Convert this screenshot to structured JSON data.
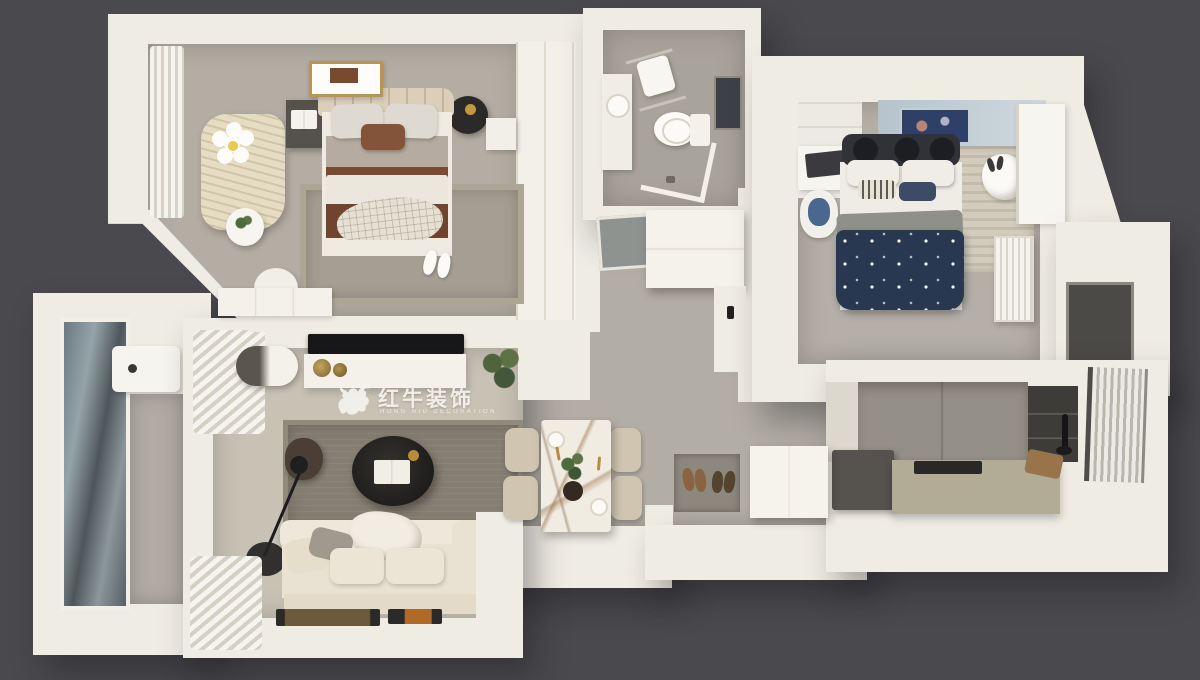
{
  "watermark": {
    "brand_cn": "红牛装饰",
    "brand_en": "HONG NIU DECORATION",
    "registered_mark": "®"
  },
  "palette": {
    "background": "#4a4a4e",
    "wall": "#efece3",
    "floor-tile": "#b2ada5",
    "floor-warm": "#c8c2b5",
    "carpet": "#b4ada3",
    "rug-living": "#867e72",
    "rug-bedroom": "#a59e92",
    "bed-brown": "#7a4a33",
    "bed-navy": "#283850",
    "accent-blue": "#b6c3cd",
    "sofa-cream": "#e9e1d1",
    "counter-olive": "#b2ab96",
    "appliance-dark": "#56524d",
    "watermark": "#f5f3ee"
  },
  "scene": {
    "type": "3d-top-down-floor-plan-render",
    "rooms": [
      {
        "id": "master-bedroom",
        "items": [
          "double-bed",
          "tufted-headboard",
          "pillows",
          "brown-blanket",
          "plaid-throw",
          "nightstand-left-with-book",
          "round-lamp-table",
          "gold-lamp",
          "striped-chaise-lounge",
          "daisy-pillow",
          "side-table-with-plant",
          "stool",
          "dresser",
          "area-rug",
          "slippers",
          "wall-art",
          "curtains",
          "wardrobe"
        ]
      },
      {
        "id": "bathroom",
        "items": [
          "toilet",
          "vanity-sink",
          "towel-rack",
          "glass-shower-enclosure",
          "dark-window",
          "floor-drain"
        ]
      },
      {
        "id": "kids-bedroom",
        "items": [
          "bed-navy-star-duvet",
          "black-headboard-cushions",
          "gray-blanket",
          "striped-pillows",
          "desk",
          "laptop",
          "desk-chair-blue-seat",
          "wardrobe",
          "striped-rug",
          "plush-toy",
          "blue-accent-wall",
          "wall-art",
          "radiator",
          "open-door"
        ]
      },
      {
        "id": "living-room",
        "items": [
          "cream-sofa",
          "cushions",
          "throw-blanket",
          "round-black-coffee-table",
          "open-book",
          "bean-bag",
          "arc-floor-lamp",
          "wall-tv",
          "tv-console",
          "gold-decor-plates",
          "potted-plant",
          "area-rug",
          "curtains",
          "air-conditioner-unit",
          "wall-trays"
        ]
      },
      {
        "id": "dining-area",
        "items": [
          "marble-dining-table",
          "dining-chair",
          "dining-chair",
          "dining-chair",
          "dining-chair",
          "centerpiece-plant",
          "place-settings",
          "gold-cutlery"
        ]
      },
      {
        "id": "kitchen",
        "items": [
          "refrigerator",
          "olive-counter",
          "cooktop",
          "dark-sink-wall",
          "faucet",
          "cutting-board",
          "window-blinds",
          "upper-cabinets"
        ]
      },
      {
        "id": "balcony",
        "items": [
          "floor-to-ceiling-glass",
          "laundry-basin",
          "tile-floor"
        ]
      },
      {
        "id": "entry-hall",
        "items": [
          "shoe-cabinet",
          "entry-cabinet",
          "doormat",
          "two-pairs-of-shoes",
          "mirror-panel",
          "utility-dark-panel"
        ]
      }
    ]
  }
}
